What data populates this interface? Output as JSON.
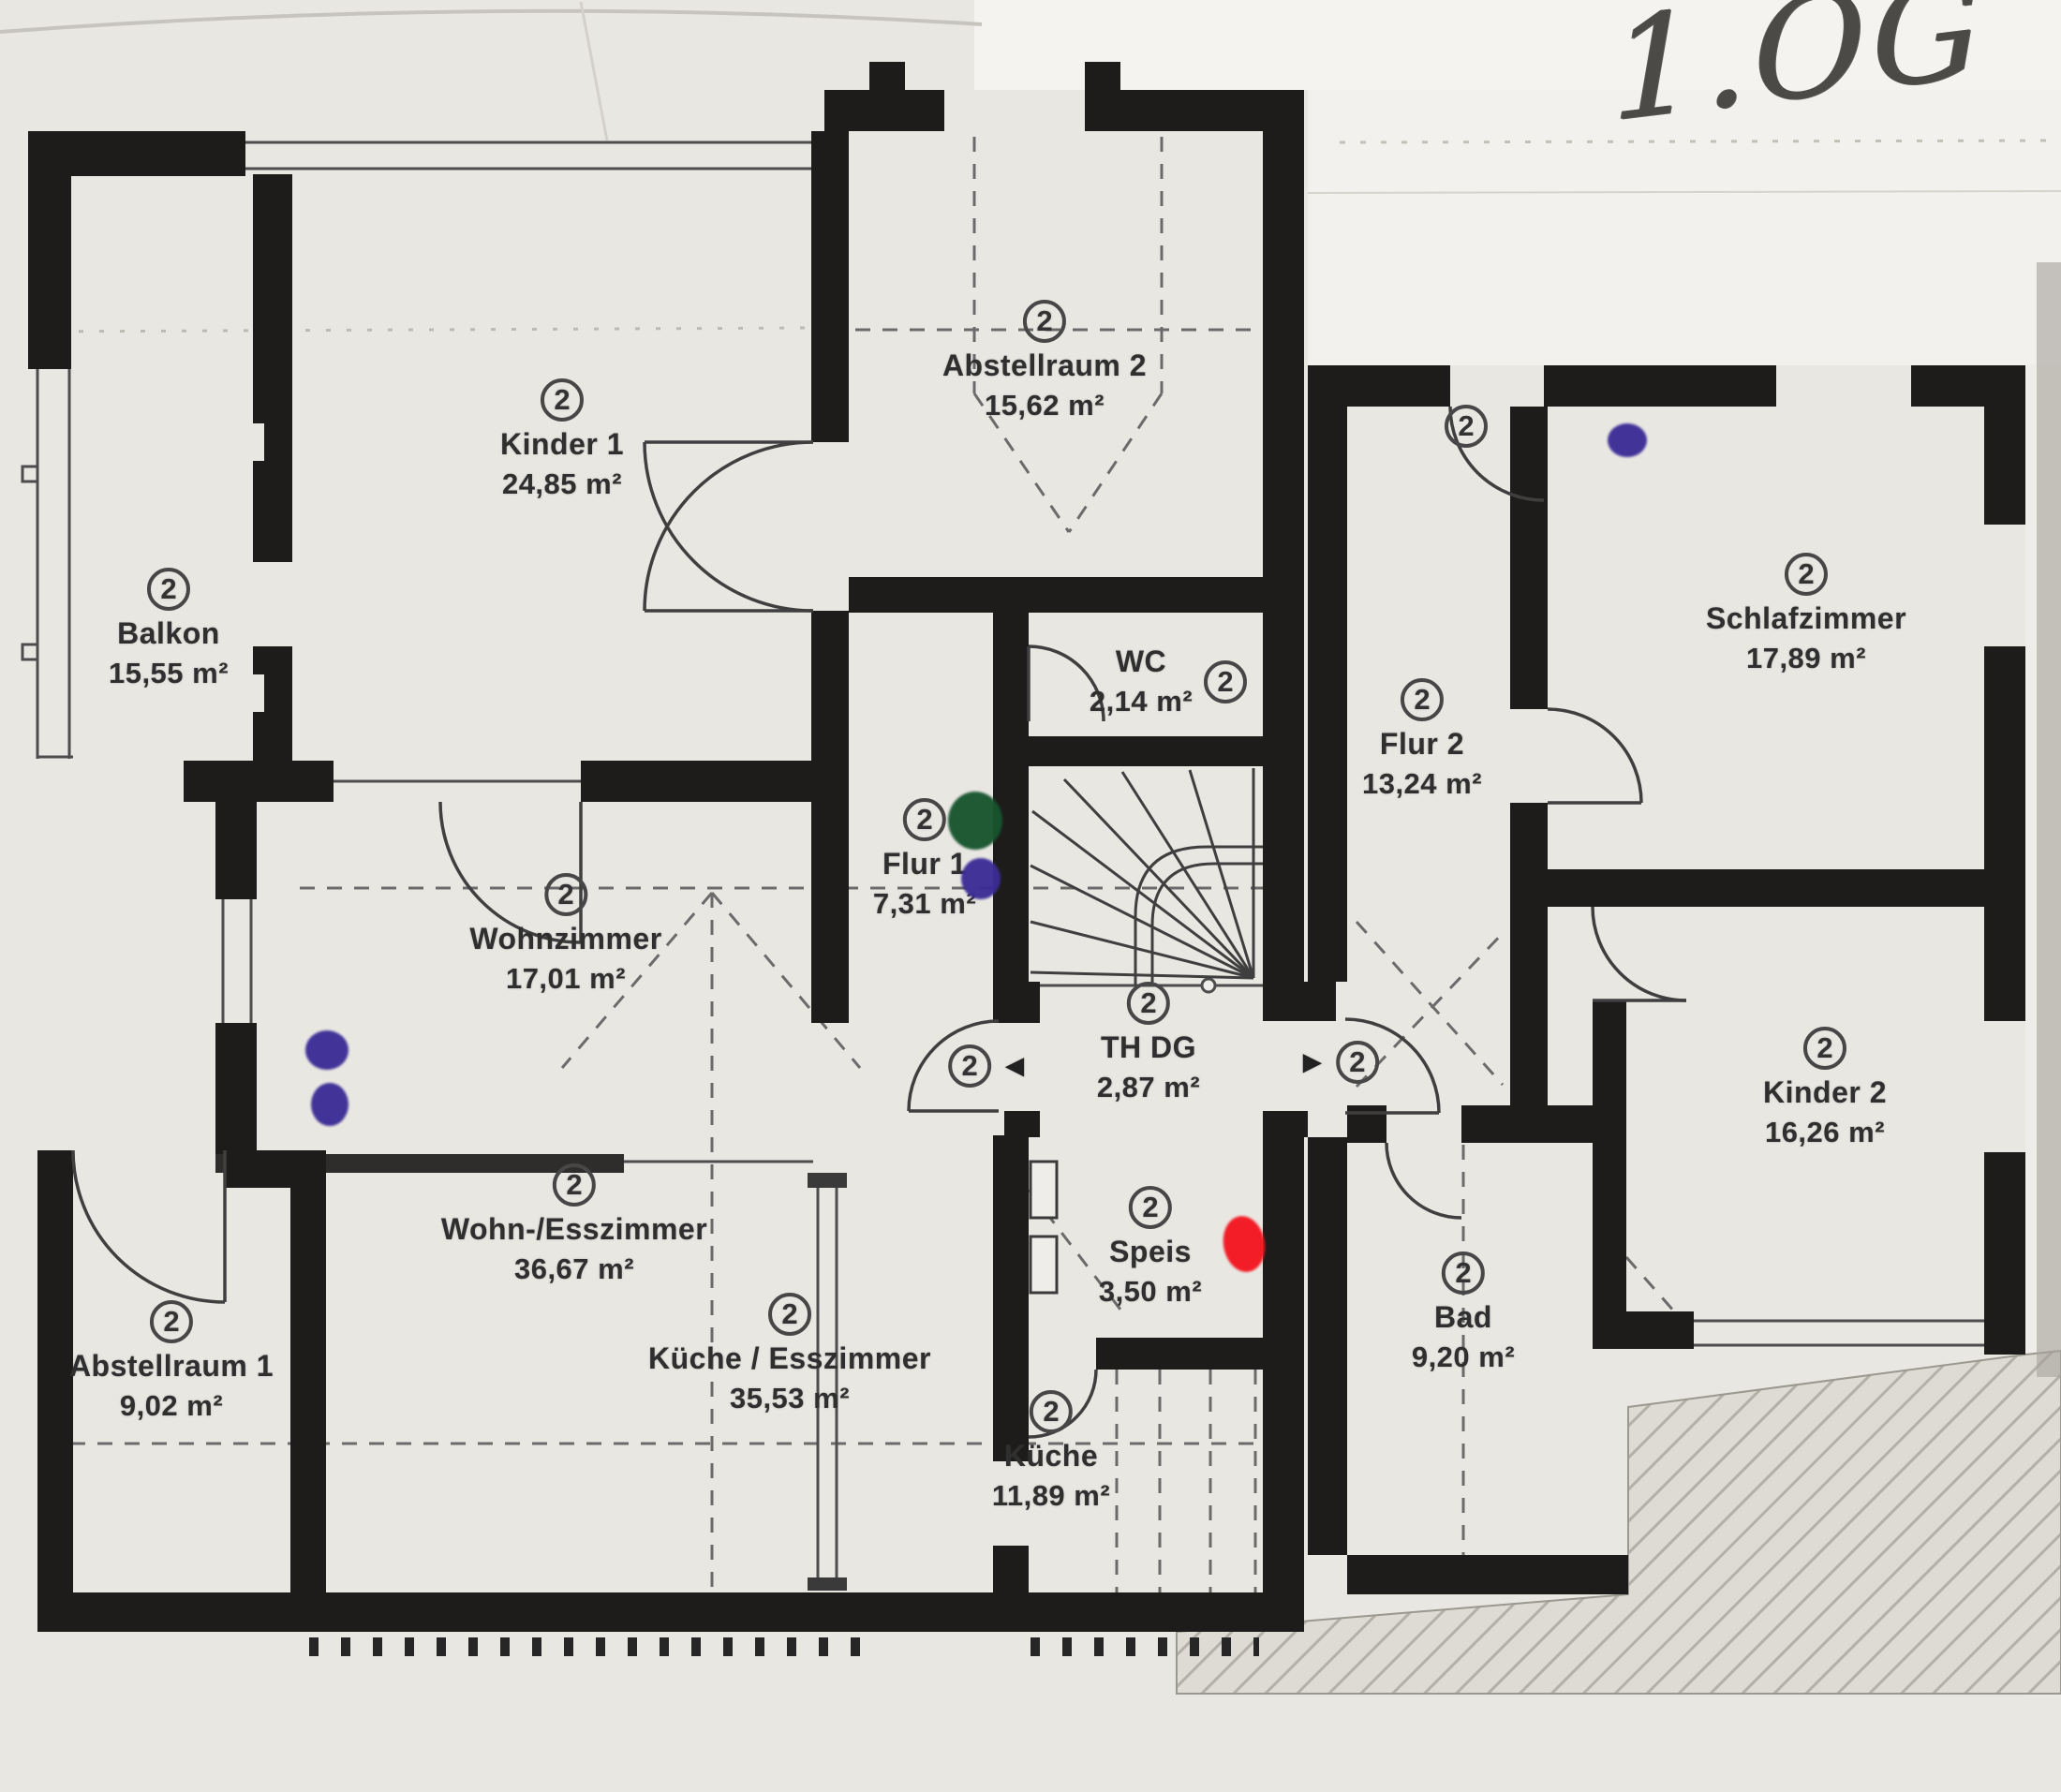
{
  "floor_label": "1.OG",
  "rooms": [
    {
      "key": "kinder1",
      "badge": "2",
      "name": "Kinder 1",
      "area": "24,85 m²"
    },
    {
      "key": "balkon",
      "badge": "2",
      "name": "Balkon",
      "area": "15,55 m²"
    },
    {
      "key": "abstellraum2",
      "badge": "2",
      "name": "Abstellraum 2",
      "area": "15,62 m²"
    },
    {
      "key": "wc",
      "badge": "2",
      "name": "WC",
      "area": "2,14 m²"
    },
    {
      "key": "flur1",
      "badge": "2",
      "name": "Flur 1",
      "area": "7,31 m²"
    },
    {
      "key": "wohnzimmer",
      "badge": "2",
      "name": "Wohnzimmer",
      "area": "17,01 m²"
    },
    {
      "key": "thdg",
      "badge": "2",
      "name": "TH DG",
      "area": "2,87 m²"
    },
    {
      "key": "flur2",
      "badge": "2",
      "name": "Flur 2",
      "area": "13,24 m²"
    },
    {
      "key": "schlafzimmer",
      "badge": "2",
      "name": "Schlafzimmer",
      "area": "17,89 m²"
    },
    {
      "key": "kinder2",
      "badge": "2",
      "name": "Kinder 2",
      "area": "16,26 m²"
    },
    {
      "key": "wohnesszimmer",
      "badge": "2",
      "name": "Wohn-/Esszimmer",
      "area": "36,67 m²"
    },
    {
      "key": "abstellraum1",
      "badge": "2",
      "name": "Abstellraum 1",
      "area": "9,02 m²"
    },
    {
      "key": "kueche_esszimmer",
      "badge": "2",
      "name": "Küche / Esszimmer",
      "area": "35,53 m²"
    },
    {
      "key": "speis",
      "badge": "2",
      "name": "Speis",
      "area": "3,50 m²"
    },
    {
      "key": "kueche",
      "badge": "2",
      "name": "Küche",
      "area": "11,89 m²"
    },
    {
      "key": "bad",
      "badge": "2",
      "name": "Bad",
      "area": "9,20 m²"
    }
  ],
  "stair_markers": {
    "left_badge": "2",
    "left_arrow": "◄",
    "right_arrow": "►",
    "right_badge": "2"
  },
  "entry_marker": {
    "badge": "2"
  },
  "annotations": {
    "marker_colors": {
      "purple": "#3b2c96",
      "green": "#17552f",
      "red": "#f3151f"
    }
  }
}
